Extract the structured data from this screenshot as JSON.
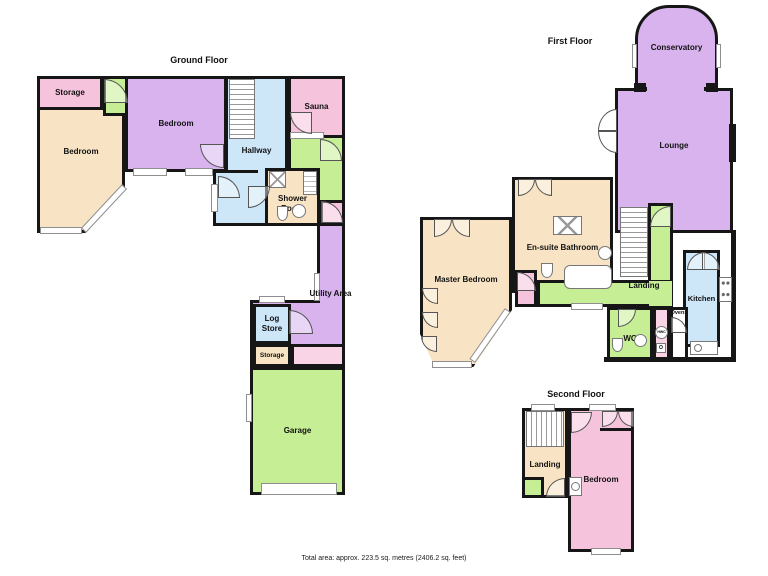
{
  "palette": {
    "pink": "#F6C3DC",
    "pink_light": "#F8D4E6",
    "cream": "#F8E4C4",
    "purple": "#D8B3EE",
    "blue": "#CDE6F8",
    "green": "#C6EF95",
    "wall": "#161616"
  },
  "floors": {
    "ground": {
      "title": "Ground Floor",
      "rooms": {
        "storage_top": "Storage",
        "bedroom_left": "Bedroom",
        "bedroom_top": "Bedroom",
        "hallway": "Hallway",
        "sauna": "Sauna",
        "shower_room": "Shower Room",
        "utility_area": "Utility Area",
        "log_store": "Log Store",
        "storage_mid": "Storage",
        "garage": "Garage"
      }
    },
    "first": {
      "title": "First Floor",
      "rooms": {
        "conservatory": "Conservatory",
        "lounge": "Lounge",
        "master_bedroom": "Master Bedroom",
        "ensuite": "En-suite Bathroom",
        "landing": "Landing",
        "kitchen": "Kitchen",
        "wc": "WC",
        "ovens": "Ovens",
        "hwc": "HWC",
        "o": "O"
      }
    },
    "second": {
      "title": "Second Floor",
      "rooms": {
        "landing": "Landing",
        "bedroom": "Bedroom"
      }
    }
  },
  "footer": {
    "text": "Total area: approx. 223.5 sq. metres (2406.2 sq. feet)"
  }
}
